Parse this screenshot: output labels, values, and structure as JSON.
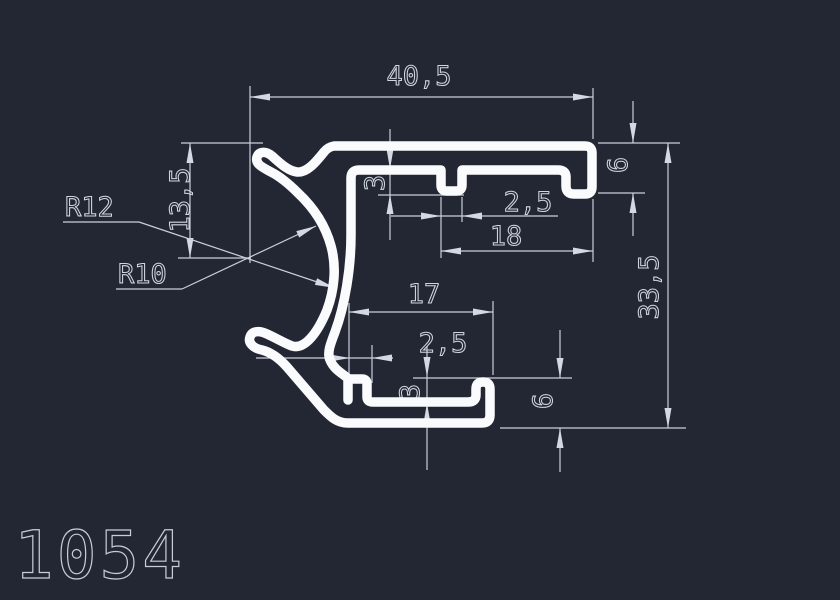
{
  "canvas": {
    "background": "#232733",
    "line_color": "#c9d0da",
    "profile_color": "#fafbfd",
    "description": "CAD cross-section drawing of aluminium profile 1054"
  },
  "title_block": {
    "profile_number": "1054"
  },
  "dimensions": {
    "overall_width": "40,5",
    "claw_height": "13,5",
    "radius_outer": "R12",
    "radius_inner": "R10",
    "top_tooth_depth": "3",
    "top_tooth_width": "2,5",
    "top_groove_width": "18",
    "top_groove_height": "6",
    "overall_height": "33,5",
    "bottom_groove_width": "17",
    "bottom_tooth_width": "2,5",
    "bottom_tooth_depth": "3",
    "bottom_groove_height": "6"
  }
}
